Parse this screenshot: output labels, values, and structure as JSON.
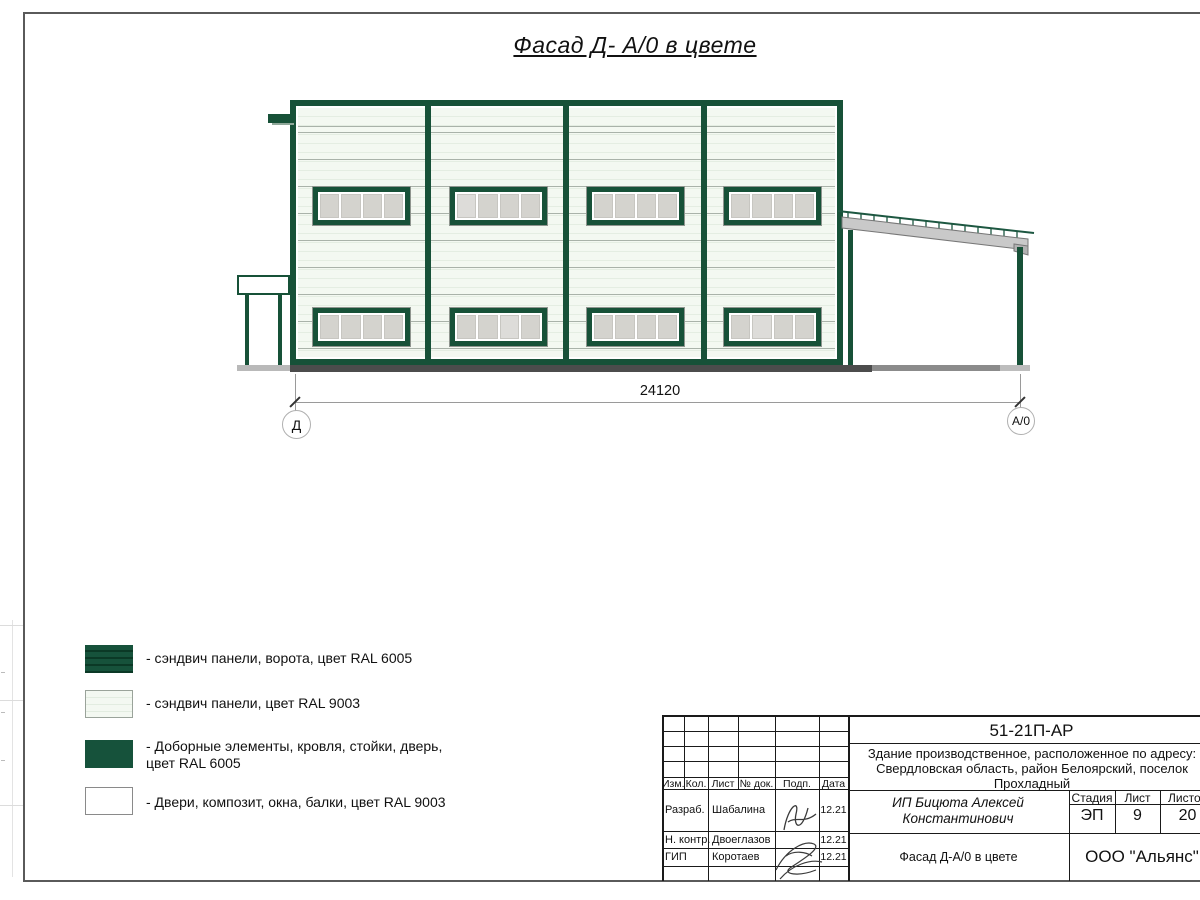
{
  "title": {
    "text": "Фасад Д- А/0 в цвете"
  },
  "elevation": {
    "dimension_label": "24120",
    "axis_left": "Д",
    "axis_right": "А/0"
  },
  "legend": {
    "items": [
      {
        "swatch": "ral6005-striped",
        "label": "- сэндвич панели, ворота, цвет RAL 6005"
      },
      {
        "swatch": "ral9003-striped",
        "label": "- сэндвич панели, цвет RAL 9003"
      },
      {
        "swatch": "ral6005-solid",
        "label_line1": "- Доборные элементы, кровля, стойки, дверь,",
        "label_line2": "цвет RAL 6005"
      },
      {
        "swatch": "ral9003-solid",
        "label": "- Двери, композит, окна, балки, цвет RAL 9003"
      }
    ]
  },
  "title_block": {
    "doc_number": "51-21П-АР",
    "description_lines": [
      "Здание производственное, расположенное по адресу:",
      "Свердловская область, район Белоярский, поселок",
      "Прохладный"
    ],
    "rev_headers": [
      "Изм.",
      "Кол.",
      "Лист",
      "№ док.",
      "Подп.",
      "Дата"
    ],
    "signers": [
      {
        "role": "Разраб.",
        "name": "Шабалина",
        "date": "12.21"
      },
      {
        "role": "Н. контр.",
        "name": "Двоеглазов",
        "date": "12.21"
      },
      {
        "role": "ГИП",
        "name": "Коротаев",
        "date": "12.21"
      }
    ],
    "client": "ИП Бицюта Алексей Константинович",
    "stage_headers": {
      "stage": "Стадия",
      "sheet": "Лист",
      "sheets": "Листов"
    },
    "stage_values": {
      "stage": "ЭП",
      "sheet": "9",
      "sheets": "20"
    },
    "sheet_title": "Фасад Д-А/0 в цвете",
    "organization": "ООО \"Альянс\""
  },
  "colors": {
    "ral6005": "#175138",
    "ral9003": "#f3f8f1",
    "ground_dark": "#4c4c4c",
    "frame_gray": "#5a5a5a"
  }
}
